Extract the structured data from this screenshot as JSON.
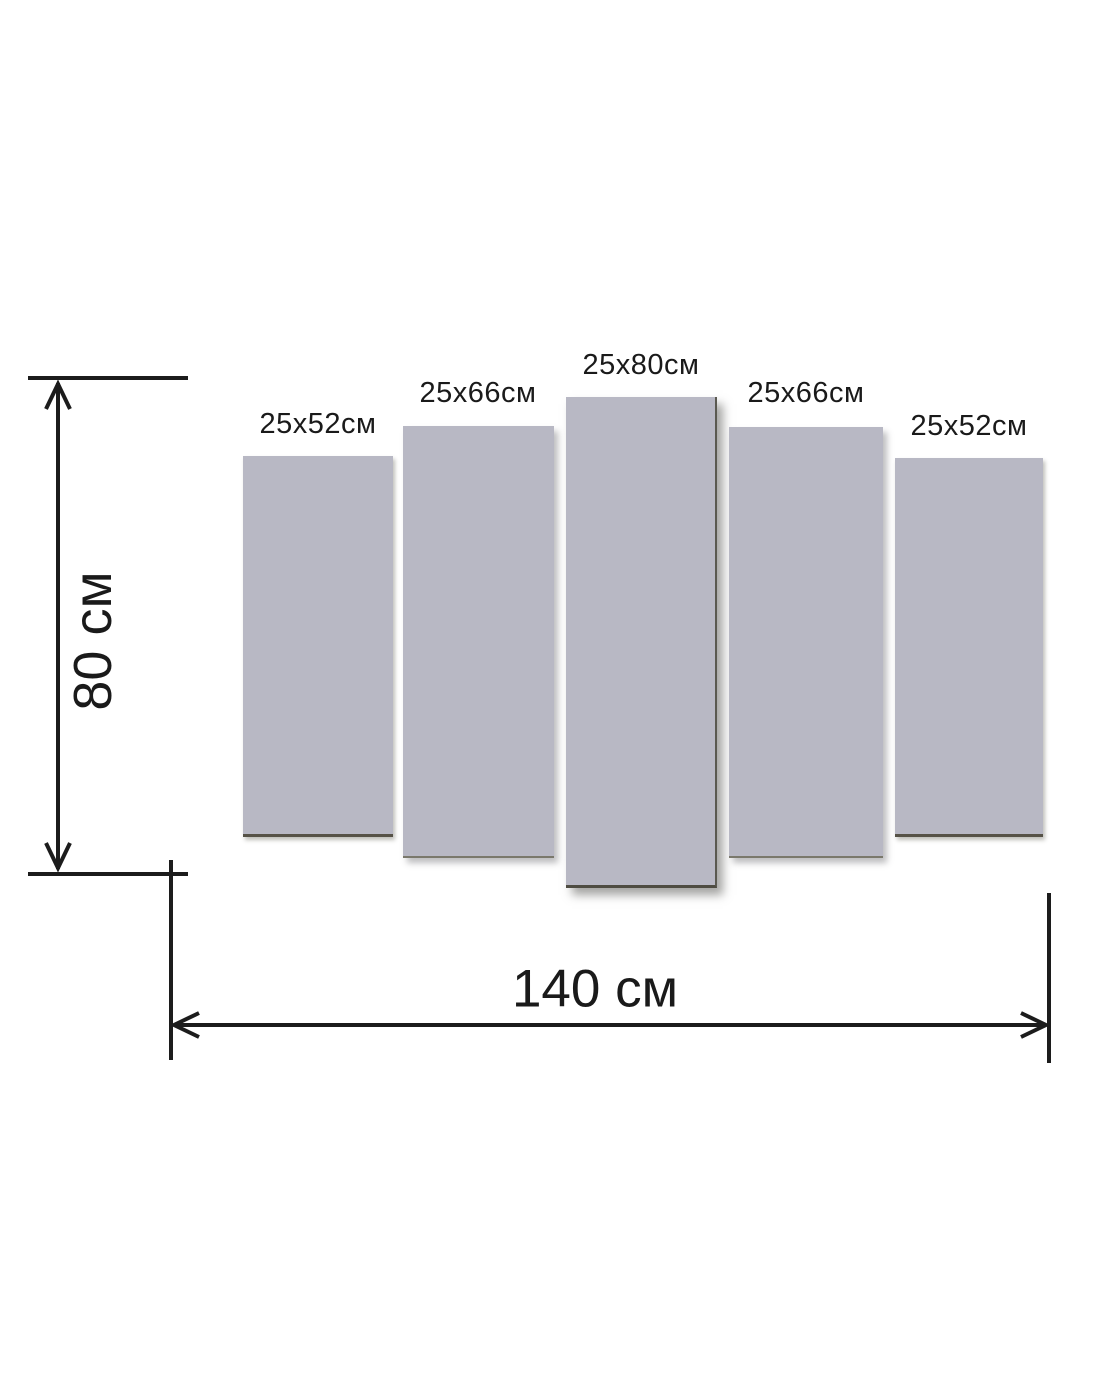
{
  "diagram": {
    "type": "modular-picture-size-diagram",
    "panel_count": 5,
    "panels": [
      {
        "label": "25x52см"
      },
      {
        "label": "25x66см"
      },
      {
        "label": "25x80см"
      },
      {
        "label": "25x66см"
      },
      {
        "label": "25x52см"
      }
    ],
    "height_dimension": {
      "label": "80 см"
    },
    "width_dimension": {
      "label": "140 см"
    },
    "colors": {
      "panel_fill": "#b8b8c4",
      "panel_edge": "#565247",
      "dimension_line": "#1c1c1c",
      "text": "#1a1a1a",
      "background": "#ffffff"
    }
  }
}
